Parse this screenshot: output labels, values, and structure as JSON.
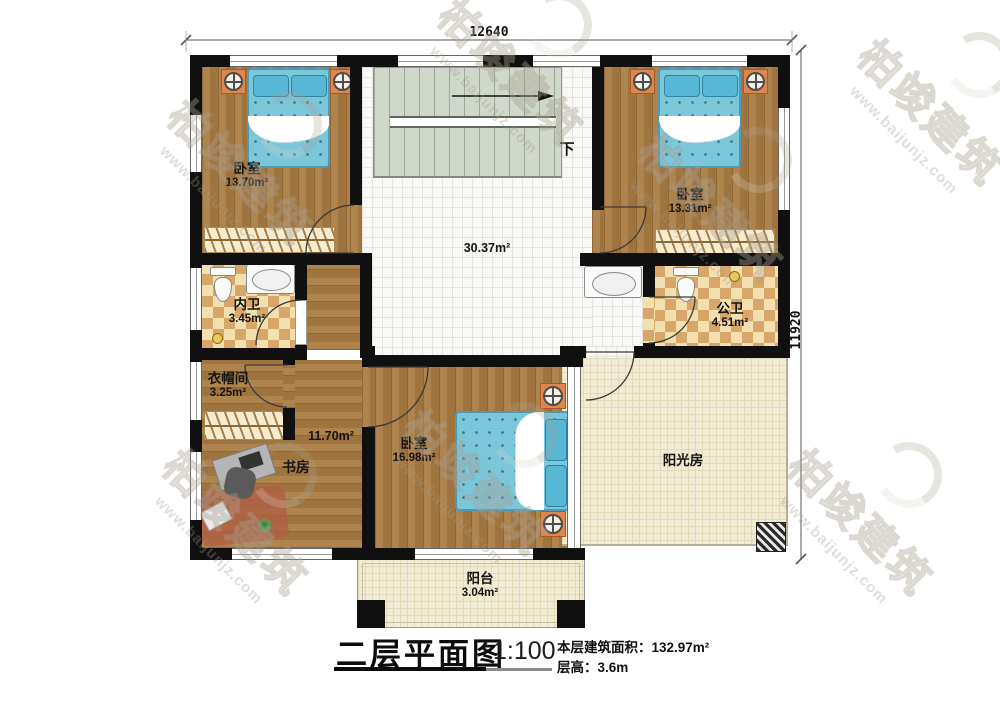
{
  "dimensions": {
    "top": "12640",
    "right": "11920"
  },
  "stairs": {
    "down_label": "下"
  },
  "rooms": {
    "bedroom_tl": {
      "name": "卧室",
      "area": "13.70m²"
    },
    "bath_inner": {
      "name": "内卫",
      "area": "3.45m²"
    },
    "cloakroom": {
      "name": "衣帽间",
      "area": "3.25m²"
    },
    "study": {
      "name": "书房",
      "area": "11.70m²"
    },
    "hall": {
      "area": "30.37m²"
    },
    "bedroom_bottom": {
      "name": "卧室",
      "area": "16.98m²"
    },
    "bath_public": {
      "name": "公卫",
      "area": "4.51m²"
    },
    "bedroom_tr": {
      "name": "卧室",
      "area": "13.31m²"
    },
    "sunroom": {
      "name": "阳光房"
    },
    "balcony": {
      "name": "阳台",
      "area": "3.04m²"
    }
  },
  "title_block": {
    "title": "二层平面图",
    "scale": "1:100",
    "area_text": "本层建筑面积：132.97m²",
    "floor_height_text": "层高：3.6m"
  },
  "watermark": {
    "brand": "柏竣建筑",
    "url": "www.baijunjz.com"
  }
}
